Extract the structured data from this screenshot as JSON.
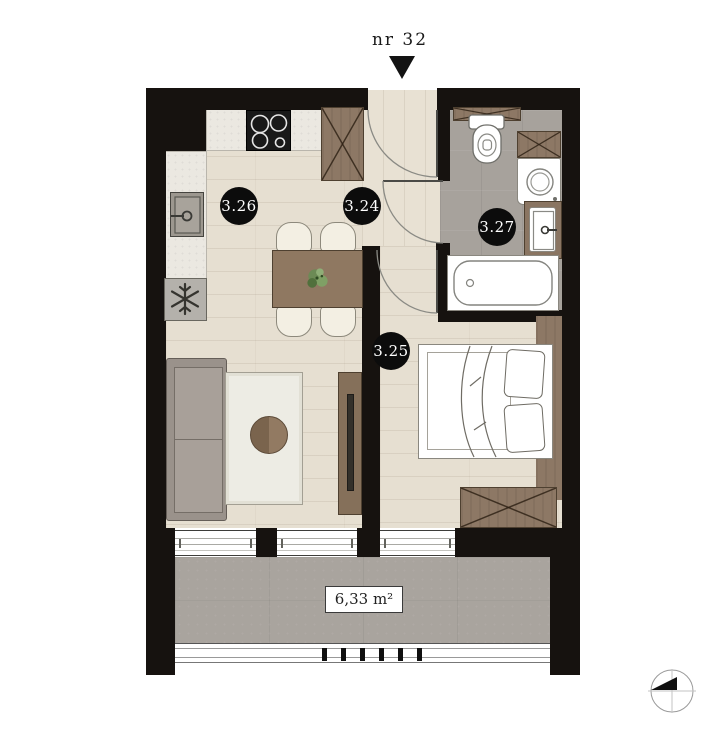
{
  "unit": {
    "label": "nr 32"
  },
  "rooms": [
    {
      "number": "3.26",
      "type": "kitchen-living-room"
    },
    {
      "number": "3.24",
      "type": "hallway"
    },
    {
      "number": "3.27",
      "type": "bathroom"
    },
    {
      "number": "3.25",
      "type": "bedroom"
    }
  ],
  "balcony": {
    "area": "6,33 m²"
  },
  "icons": {
    "entrance-arrow-icon": "filled downward triangle",
    "compass-icon": "circle with crosshair and black quadrant triangle",
    "stove-icon": "black cooktop with 4 burner circles",
    "sink-icon": "square basin with tap",
    "freezer-icon": "box with snowflake",
    "wardrobe-icon": "rectangle with X cross",
    "toilet-icon": "tank and bowl",
    "washing-machine-icon": "box with round drum",
    "bathtub-icon": "rounded tub outline",
    "door-swing-icon": "quarter-circle arc with leaf"
  },
  "colors": {
    "wall": "#16120f",
    "wood_floor": "#e6dfd1",
    "tile_floor": "#a7a29c",
    "concrete": "#a9a49e",
    "furniture_wood": "#8d7865",
    "counter": "#ebe8e1",
    "label_circle": "#0c0c0c",
    "label_text": "#ffffff"
  }
}
